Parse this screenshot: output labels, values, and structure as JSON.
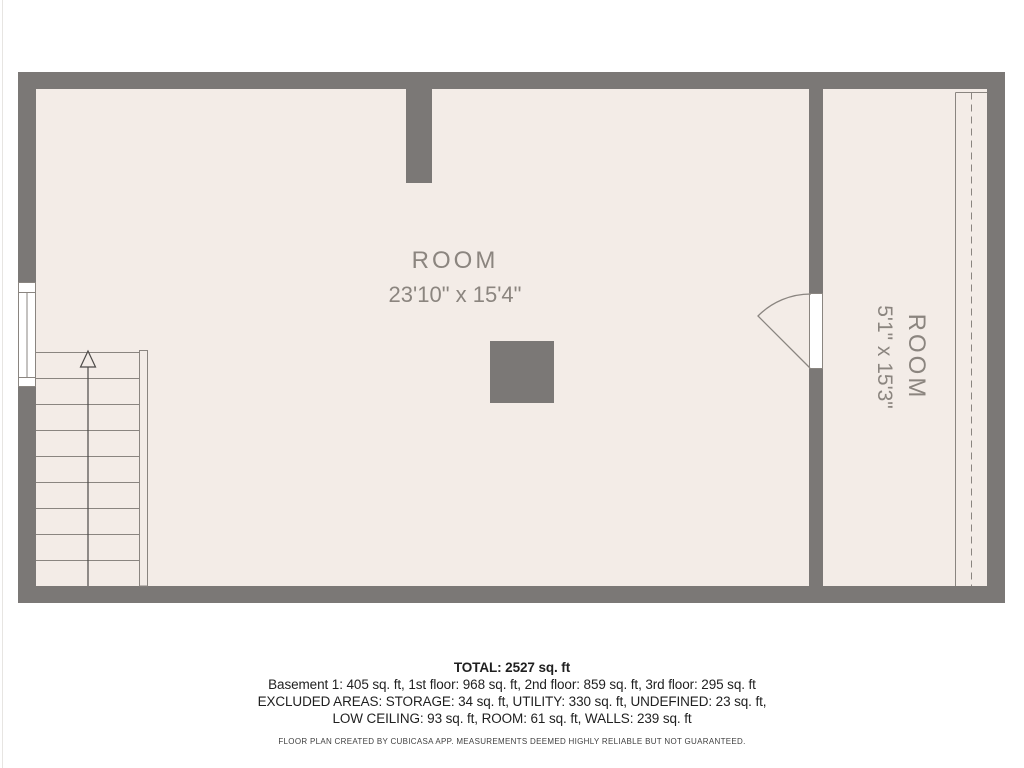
{
  "floor_plan": {
    "rooms": [
      {
        "name": "ROOM",
        "dimensions": "23'10\" x 15'4\""
      },
      {
        "name": "ROOM",
        "dimensions": "5'1\" x 15'3\""
      }
    ],
    "symbols": [
      "staircase-up-arrow",
      "door-swing",
      "window",
      "column",
      "low-ceiling-dashed-boundary"
    ],
    "colors": {
      "wall": "#7b7876",
      "floor": "#f3ece7",
      "plan_line": "#8a8580",
      "room_label": "#8b857f",
      "footer_text": "#1f1f1f"
    }
  },
  "footer": {
    "total": "TOTAL: 2527 sq. ft",
    "floors": "Basement 1: 405 sq. ft, 1st floor: 968 sq. ft, 2nd floor: 859 sq. ft, 3rd floor: 295 sq. ft",
    "excluded_line1": "EXCLUDED AREAS: STORAGE: 34 sq. ft, UTILITY: 330 sq. ft, UNDEFINED: 23 sq. ft,",
    "excluded_line2": "LOW CEILING: 93 sq. ft, ROOM: 61 sq. ft, WALLS: 239 sq. ft",
    "disclaimer": "FLOOR PLAN CREATED BY CUBICASA APP. MEASUREMENTS DEEMED HIGHLY RELIABLE BUT NOT GUARANTEED."
  }
}
